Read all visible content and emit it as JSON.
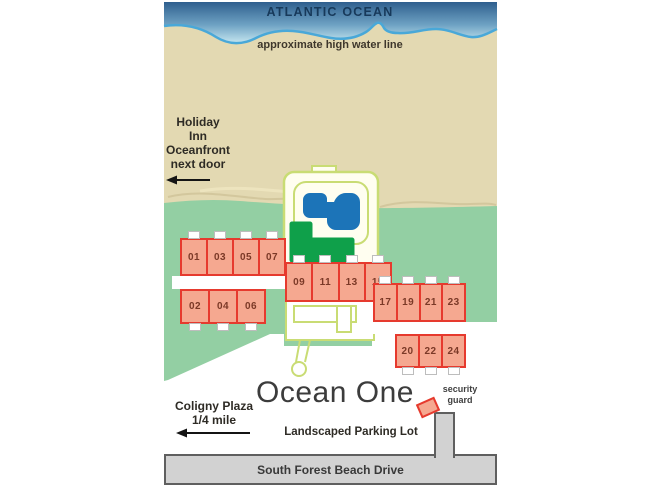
{
  "labels": {
    "ocean": "ATLANTIC OCEAN",
    "high_water": "approximate high water line",
    "holiday_inn": "Holiday\nInn\nOceanfront\nnext door",
    "coligny": "Coligny Plaza\n1/4 mile",
    "title": "Ocean One",
    "security_guard": "security\nguard",
    "parking": "Landscaped Parking Lot",
    "road": "South Forest Beach Drive"
  },
  "units": {
    "left_top": [
      "01",
      "03",
      "05",
      "07"
    ],
    "left_bottom": [
      "02",
      "04",
      "06"
    ],
    "middle": [
      "09",
      "11",
      "13",
      "15"
    ],
    "right_top": [
      "17",
      "19",
      "21",
      "23"
    ],
    "right_bottom": [
      "20",
      "22",
      "24"
    ]
  },
  "colors": {
    "ocean_top": "#2f5f8e",
    "ocean_bottom": "#c9e9f2",
    "wave_line": "#49a8d8",
    "sand": "#e3d9b2",
    "lawn": "#93cfa3",
    "deck": "#fffef0",
    "path_outline": "#c9dc74",
    "pool": "#1c74b8",
    "putting_green": "#0fa04a",
    "building_fill": "#f5a890",
    "building_border": "#e63a2e",
    "unit_number": "#7b3927",
    "road_fill": "#d2d2d2",
    "road_border": "#5f5f5f"
  }
}
